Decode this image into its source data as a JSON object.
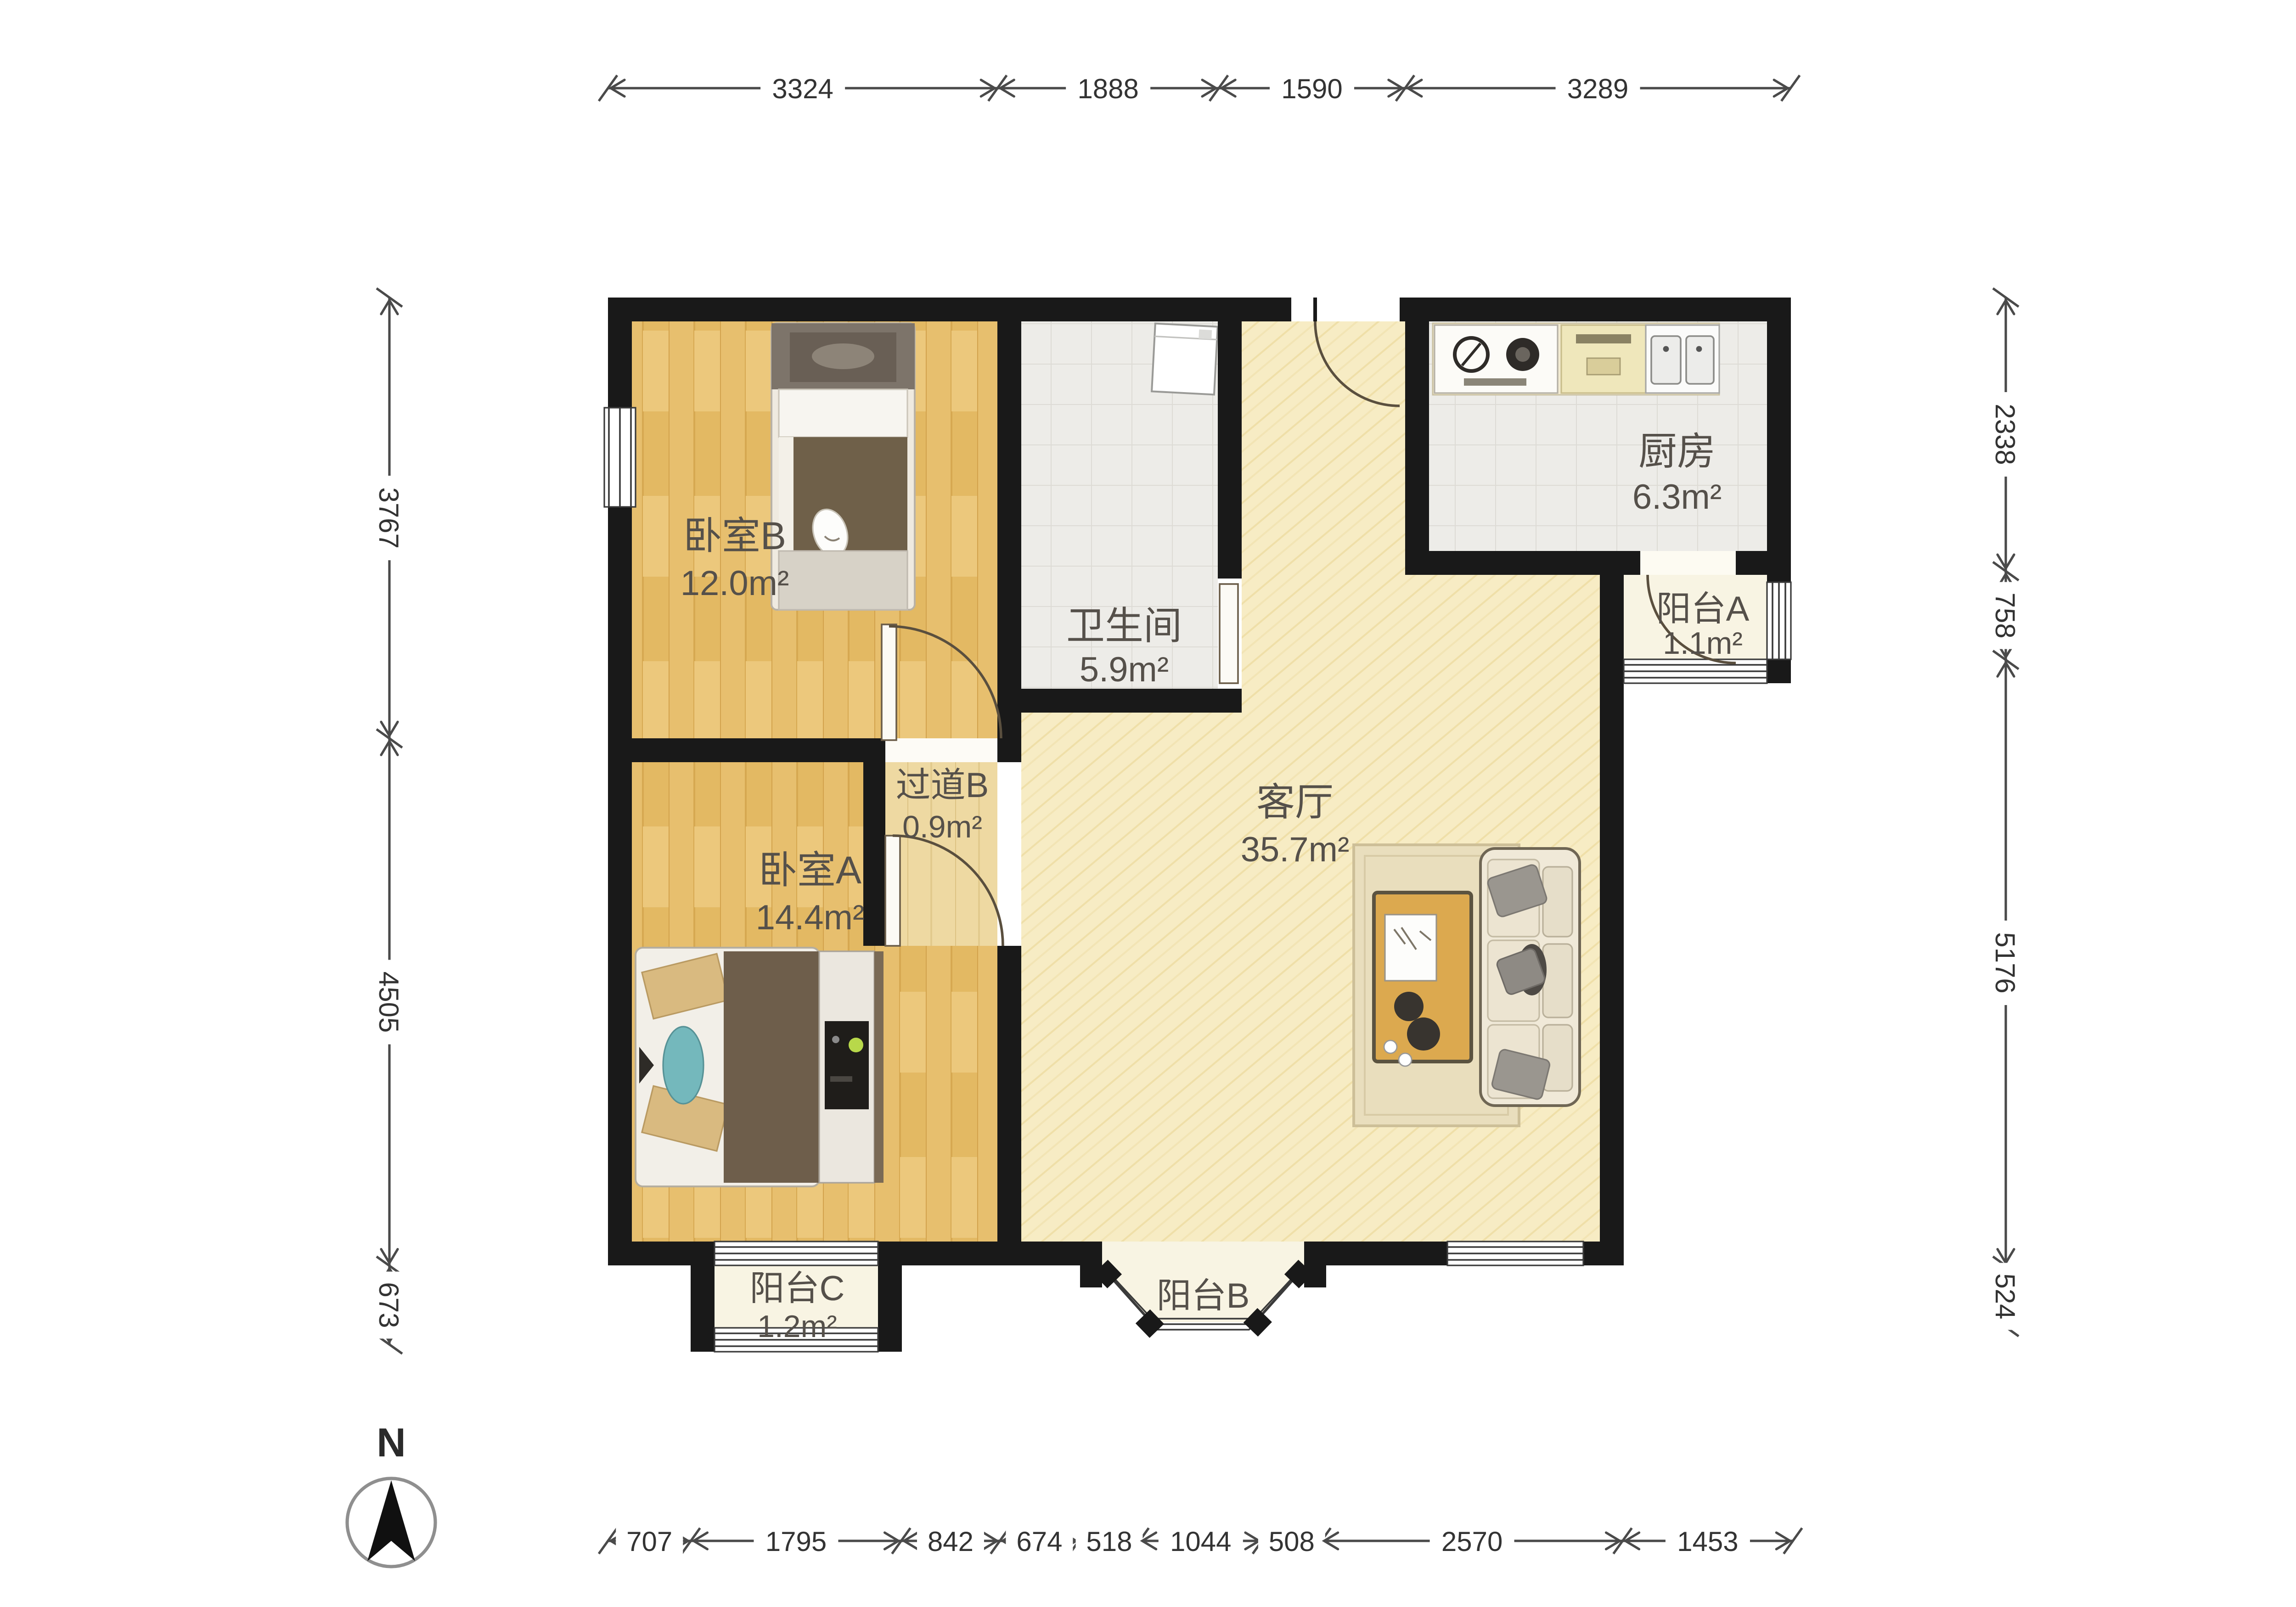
{
  "compass": {
    "label": "N"
  },
  "rooms": [
    {
      "id": "bedroom-b",
      "name": "卧室B",
      "area": "12.0m²"
    },
    {
      "id": "bathroom",
      "name": "卫生间",
      "area": "5.9m²"
    },
    {
      "id": "kitchen",
      "name": "厨房",
      "area": "6.3m²"
    },
    {
      "id": "balcony-a",
      "name": "阳台A",
      "area": "1.1m²"
    },
    {
      "id": "hallway-b",
      "name": "过道B",
      "area": "0.9m²"
    },
    {
      "id": "bedroom-a",
      "name": "卧室A",
      "area": "14.4m²"
    },
    {
      "id": "living-room",
      "name": "客厅",
      "area": "35.7m²"
    },
    {
      "id": "balcony-c",
      "name": "阳台C",
      "area": "1.2m²"
    },
    {
      "id": "balcony-b",
      "name": "阳台B",
      "area": ""
    }
  ],
  "dimensions": {
    "top": [
      "3324",
      "1888",
      "1590",
      "3289"
    ],
    "bottom": [
      "707",
      "1795",
      "842",
      "674",
      "518",
      "1044",
      "508",
      "2570",
      "1453"
    ],
    "left": [
      "3767",
      "4505",
      "673"
    ],
    "right": [
      "2338",
      "758",
      "5176",
      "524"
    ]
  },
  "colors": {
    "wall": "#191919",
    "wood_floor": "#e7bf6e",
    "hall_floor": "#eed9a2",
    "living_floor": "#f7ecc4",
    "tile_floor": "#edece8",
    "balcony_floor": "#f8f4e3",
    "dim_text": "#333333",
    "label_text": "#55504a"
  }
}
